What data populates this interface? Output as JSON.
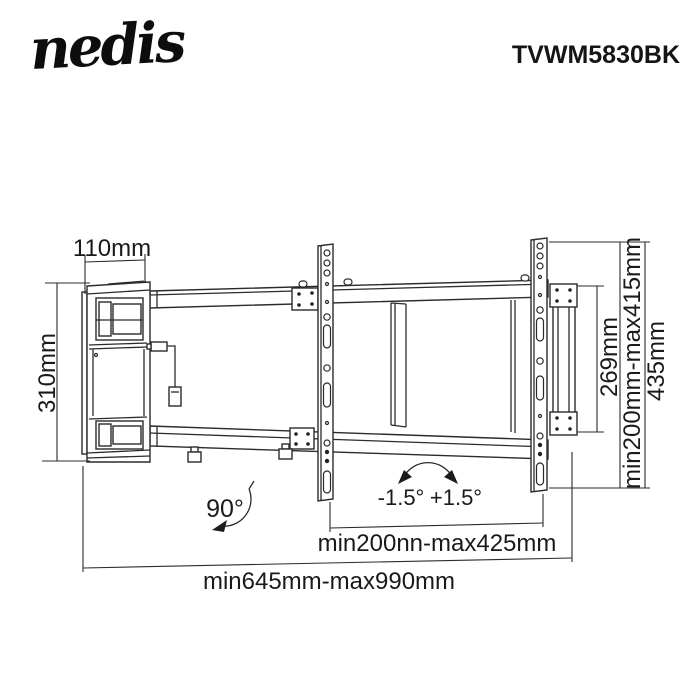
{
  "header": {
    "brand": "nedis",
    "model": "TVWM5830BK"
  },
  "dimensions": {
    "wall_plate_depth": "110mm",
    "wall_plate_height": "310mm",
    "adapter_bracket_height": "269mm",
    "vesa_vertical_range": "min200mm-max415mm",
    "rail_total_height": "435mm",
    "vesa_horizontal_range": "min200nn-max425mm",
    "extension_range": "min645mm-max990mm"
  },
  "angles": {
    "swivel": "90°",
    "tilt_negative": "-1.5°",
    "tilt_positive": "+1.5°"
  },
  "colors": {
    "line": "#2b2b2b",
    "text": "#1a1a1a",
    "background": "#ffffff"
  }
}
